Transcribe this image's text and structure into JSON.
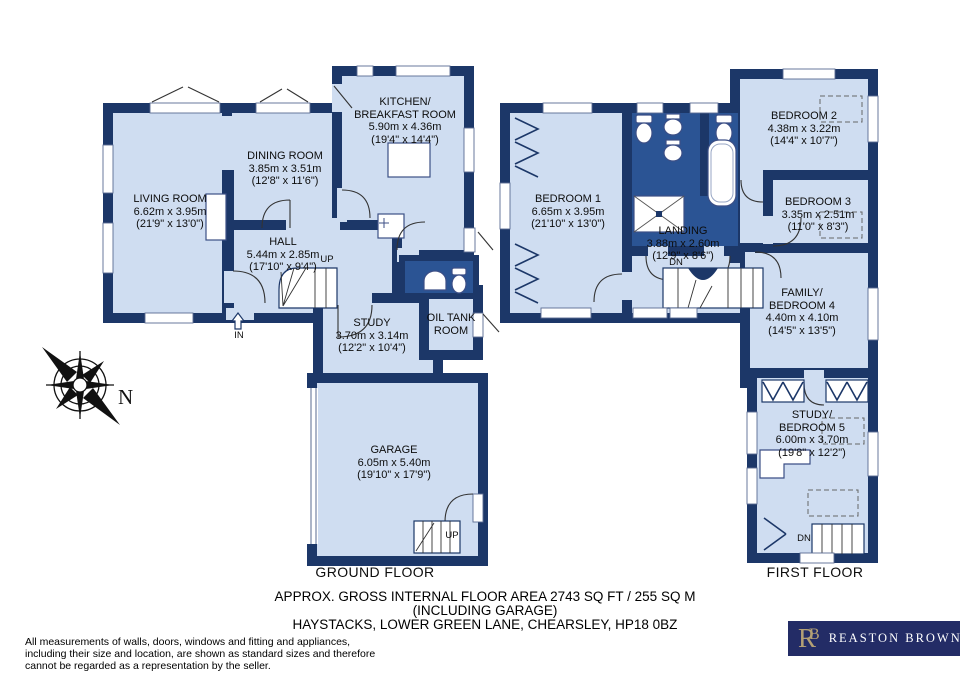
{
  "colors": {
    "wall_navy": "#1c3768",
    "room_fill": "#cfddf1",
    "wet_room_fill": "#2b5494",
    "logo_background": "#232c66",
    "logo_gold": "#b3a075",
    "logo_text": "#ffffff"
  },
  "compass": {
    "label": "N"
  },
  "annotations": {
    "up": "UP",
    "down": "DN",
    "entrance": "IN"
  },
  "ground_floor": {
    "label": "GROUND FLOOR",
    "rooms": {
      "living": {
        "name": "LIVING ROOM",
        "metric": "6.62m x 3.95m",
        "imperial": "(21'9\" x 13'0\")"
      },
      "dining": {
        "name": "DINING ROOM",
        "metric": "3.85m x 3.51m",
        "imperial": "(12'8\" x 11'6\")"
      },
      "kitchen": {
        "name": "KITCHEN/",
        "name2": "BREAKFAST ROOM",
        "metric": "5.90m x 4.36m",
        "imperial": "(19'4\" x 14'4\")"
      },
      "hall": {
        "name": "HALL",
        "metric": "5.44m x 2.85m",
        "imperial": "(17'10\" x 9'4\")"
      },
      "study": {
        "name": "STUDY",
        "metric": "3.70m x 3.14m",
        "imperial": "(12'2\" x 10'4\")"
      },
      "oil_tank": {
        "name": "OIL TANK",
        "name2": "ROOM"
      },
      "garage": {
        "name": "GARAGE",
        "metric": "6.05m x 5.40m",
        "imperial": "(19'10\" x 17'9\")"
      }
    }
  },
  "first_floor": {
    "label": "FIRST FLOOR",
    "rooms": {
      "bedroom1": {
        "name": "BEDROOM 1",
        "metric": "6.65m x 3.95m",
        "imperial": "(21'10\" x 13'0\")"
      },
      "landing": {
        "name": "LANDING",
        "metric": "3.88m x 2.60m",
        "imperial": "(12'9\" x 8'6\")"
      },
      "bedroom2": {
        "name": "BEDROOM 2",
        "metric": "4.38m x 3.22m",
        "imperial": "(14'4\" x 10'7\")"
      },
      "bedroom3": {
        "name": "BEDROOM 3",
        "metric": "3.35m x 2.51m",
        "imperial": "(11'0\" x 8'3\")"
      },
      "bedroom4": {
        "name": "FAMILY/",
        "name2": "BEDROOM 4",
        "metric": "4.40m x 4.10m",
        "imperial": "(14'5\" x 13'5\")"
      },
      "bedroom5": {
        "name": "STUDY/",
        "name2": "BEDROOM 5",
        "metric": "6.00m x 3.70m",
        "imperial": "(19'8\" x 12'2\")"
      }
    }
  },
  "footer": {
    "line1": "APPROX. GROSS INTERNAL FLOOR AREA 2743 SQ FT / 255 SQ M",
    "line2": "(INCLUDING GARAGE)",
    "line3": "HAYSTACKS, LOWER GREEN LANE, CHEARSLEY, HP18 0BZ"
  },
  "disclaimer": {
    "line1": "All measurements of walls, doors, windows and fitting and appliances,",
    "line2": "including their size and location, are shown as standard sizes and therefore",
    "line3": "cannot be regarded as a representation by the seller."
  },
  "logo": {
    "monogram_r": "R",
    "monogram_b": "B",
    "name": "REASTON BROWN"
  }
}
